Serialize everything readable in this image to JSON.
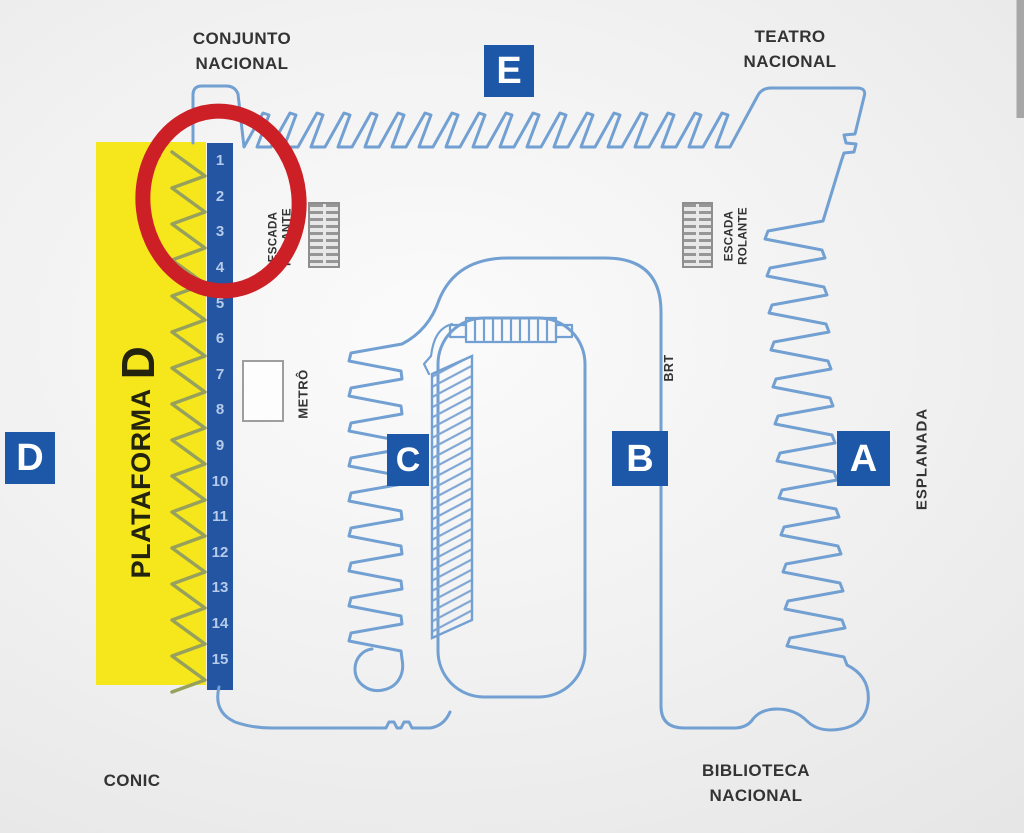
{
  "labels": {
    "conjunto": [
      "CONJUNTO",
      "NACIONAL"
    ],
    "teatro": [
      "TEATRO",
      "NACIONAL"
    ],
    "biblioteca": [
      "BIBLIOTECA",
      "NACIONAL"
    ],
    "conic": "CONIC",
    "esplanada": "ESPLANADA",
    "escada": [
      "ESCADA",
      "ROLANTE"
    ],
    "metro": "METRÔ",
    "brt": "BRT"
  },
  "platforms": {
    "a": "A",
    "b": "B",
    "c": "C",
    "d": "D",
    "e": "E"
  },
  "platform_d": {
    "name": "PLATAFORMA",
    "letter": "D",
    "bays": [
      "1",
      "2",
      "3",
      "4",
      "5",
      "6",
      "7",
      "8",
      "9",
      "10",
      "11",
      "12",
      "13",
      "14",
      "15"
    ]
  },
  "annotation": {
    "shape": "hand-drawn-circle",
    "marks_bays": [
      "1",
      "2",
      "3",
      "4"
    ],
    "color": "#cc2026"
  },
  "colors": {
    "map_line": "#72a0d2",
    "platform_badge": "#1d57a8",
    "strip_blue": "#2355a2",
    "bay_number": "#b5cbe9",
    "platform_d_yellow": "#f6e71d",
    "bay_zigzag_olive": "#97a15c",
    "annotation_red": "#cc2026",
    "label_text": "#333333",
    "background": "#ededed"
  }
}
